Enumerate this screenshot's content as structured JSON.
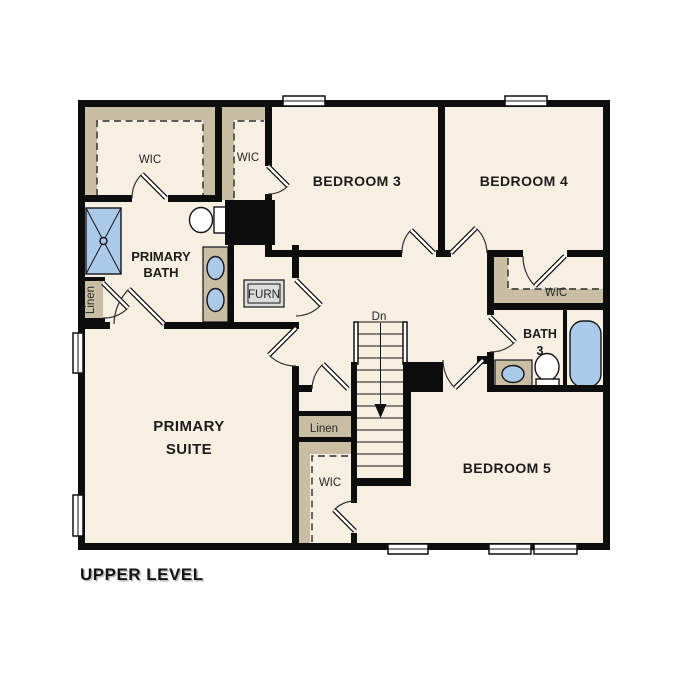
{
  "plan": {
    "title": "UPPER LEVEL",
    "level": "Upper Level Floor Plan"
  },
  "labels": {
    "wic_primary": "WIC",
    "wic_bedroom3": "WIC",
    "bedroom3": "BEDROOM 3",
    "bedroom4": "BEDROOM 4",
    "primary_bath_1": "PRIMARY",
    "primary_bath_2": "BATH",
    "furn": "FURN",
    "wic_bedroom4": "WIC",
    "bath3_1": "BATH",
    "bath3_2": "3",
    "linen_bath": "Linen",
    "primary_suite_1": "PRIMARY",
    "primary_suite_2": "SUITE",
    "stairs_down": "Dn",
    "linen_hall": "Linen",
    "wic_bedroom5": "WIC",
    "bedroom5": "BEDROOM 5"
  },
  "colors": {
    "floor": "#f6efe2",
    "closet_shelf": "#c9bda4",
    "fixture_blue": "#abc9e8",
    "wall": "#0d0d0d",
    "furnace_gray": "#dcdcdc",
    "background": "#ffffff"
  }
}
